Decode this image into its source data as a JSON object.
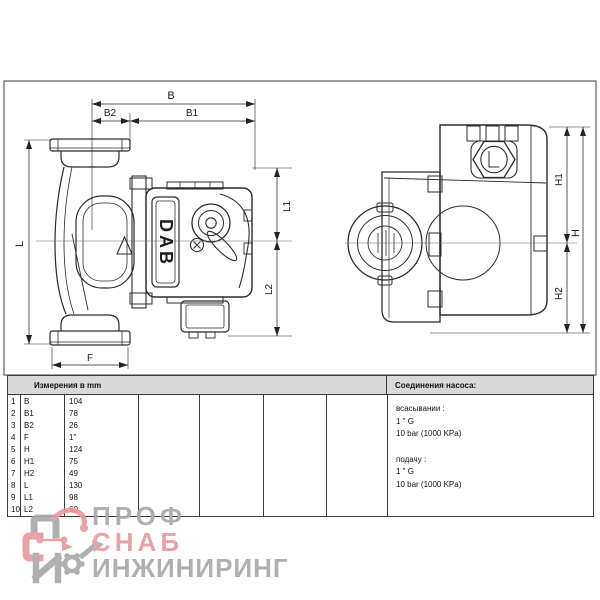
{
  "drawing": {
    "brand": "DAB",
    "labels": {
      "B": "B",
      "B1": "B1",
      "B2": "B2",
      "F": "F",
      "L": "L",
      "L1": "L1",
      "L2": "L2",
      "H": "H",
      "H1": "H1",
      "H2": "H2"
    }
  },
  "table": {
    "header": "Измерения в  mm",
    "rows": [
      {
        "n": "1",
        "dim": "B",
        "value": "104"
      },
      {
        "n": "2",
        "dim": "B1",
        "value": "78"
      },
      {
        "n": "3",
        "dim": "B2",
        "value": "26"
      },
      {
        "n": "4",
        "dim": "F",
        "value": "1\""
      },
      {
        "n": "5",
        "dim": "H",
        "value": "124"
      },
      {
        "n": "6",
        "dim": "H1",
        "value": "75"
      },
      {
        "n": "7",
        "dim": "H2",
        "value": "49"
      },
      {
        "n": "8",
        "dim": "L",
        "value": "130"
      },
      {
        "n": "9",
        "dim": "L1",
        "value": "98"
      },
      {
        "n": "10",
        "dim": "L2",
        "value": "60"
      }
    ]
  },
  "connections": {
    "header": "Соединения насоса:",
    "suction_label": "всасывании :",
    "suction_size": "1 \" G",
    "suction_pressure": "10 bar (1000 KPa)",
    "discharge_label": "подачу :",
    "discharge_size": "1 \" G",
    "discharge_pressure": "10 bar (1000 KPa)"
  },
  "watermark": {
    "line1": "ПРОФ",
    "line2": "СНАБ",
    "line3": "ИНЖИНИРИНГ",
    "colors": {
      "gray": "#a8a8a8",
      "red": "#e8999c"
    }
  }
}
